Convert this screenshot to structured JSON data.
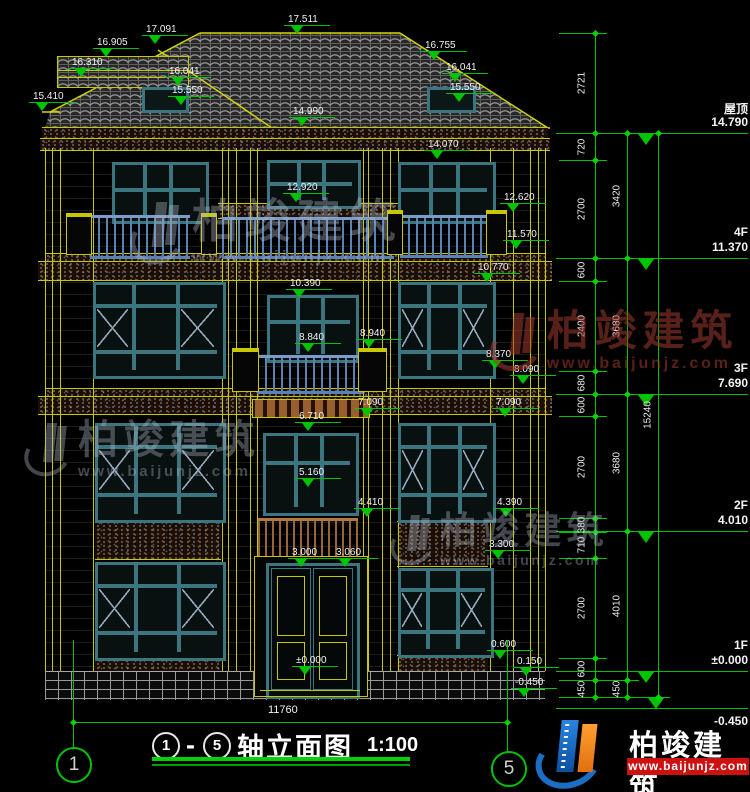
{
  "drawing_title": {
    "axis_start": "1",
    "axis_end": "5",
    "dash": "-",
    "text": "轴立面图",
    "scale": "1:100"
  },
  "bottom_dim": {
    "value": "11760"
  },
  "axis_bubbles": [
    {
      "num": "1"
    },
    {
      "num": "5"
    }
  ],
  "floor_levels": [
    {
      "label": "屋顶",
      "value": "14.790",
      "y": 133,
      "below": false
    },
    {
      "label": "4F",
      "value": "11.370",
      "y": 258,
      "below": false
    },
    {
      "label": "3F",
      "value": "7.690",
      "y": 394,
      "below": false
    },
    {
      "label": "2F",
      "value": "4.010",
      "y": 531,
      "below": false
    },
    {
      "label": "1F",
      "value": "±0.000",
      "y": 671,
      "below": false
    },
    {
      "label": "",
      "value": "-0.450",
      "y": 708,
      "below": true
    }
  ],
  "elevation_marks": [
    {
      "v": "17.511",
      "x": 288,
      "y": 14
    },
    {
      "v": "16.905",
      "x": 97,
      "y": 37
    },
    {
      "v": "17.091",
      "x": 146,
      "y": 24
    },
    {
      "v": "16.310",
      "x": 72,
      "y": 57
    },
    {
      "v": "16.041",
      "x": 169,
      "y": 66
    },
    {
      "v": "15.550",
      "x": 172,
      "y": 85
    },
    {
      "v": "15.410",
      "x": 33,
      "y": 91
    },
    {
      "v": "14.990",
      "x": 293,
      "y": 106
    },
    {
      "v": "16.755",
      "x": 425,
      "y": 40
    },
    {
      "v": "16.041",
      "x": 446,
      "y": 62
    },
    {
      "v": "15.550",
      "x": 450,
      "y": 82
    },
    {
      "v": "14.070",
      "x": 428,
      "y": 139
    },
    {
      "v": "12.920",
      "x": 287,
      "y": 182
    },
    {
      "v": "12.620",
      "x": 504,
      "y": 192
    },
    {
      "v": "11.570",
      "x": 507,
      "y": 229
    },
    {
      "v": "10.770",
      "x": 478,
      "y": 262
    },
    {
      "v": "10.390",
      "x": 290,
      "y": 278
    },
    {
      "v": "8.840",
      "x": 299,
      "y": 332
    },
    {
      "v": "8.940",
      "x": 360,
      "y": 328
    },
    {
      "v": "8.370",
      "x": 486,
      "y": 349
    },
    {
      "v": "8.090",
      "x": 514,
      "y": 364
    },
    {
      "v": "7.090",
      "x": 358,
      "y": 397
    },
    {
      "v": "7.090",
      "x": 496,
      "y": 397
    },
    {
      "v": "6.710",
      "x": 299,
      "y": 411
    },
    {
      "v": "5.160",
      "x": 299,
      "y": 467
    },
    {
      "v": "4.410",
      "x": 358,
      "y": 497
    },
    {
      "v": "4.390",
      "x": 497,
      "y": 497
    },
    {
      "v": "3.300",
      "x": 489,
      "y": 539
    },
    {
      "v": "3.000",
      "x": 292,
      "y": 547
    },
    {
      "v": "3.060",
      "x": 336,
      "y": 547
    },
    {
      "v": "±0.000",
      "x": 296,
      "y": 655
    },
    {
      "v": "0.600",
      "x": 491,
      "y": 639
    },
    {
      "v": "0.150",
      "x": 517,
      "y": 656
    },
    {
      "v": "-0.450",
      "x": 515,
      "y": 677
    }
  ],
  "dim_chains": [
    {
      "x": 595,
      "label_x": 582,
      "boundaries": [
        33,
        133,
        160,
        258,
        281,
        371,
        394,
        416,
        518,
        532,
        558,
        658,
        680,
        697
      ],
      "labels": [
        "2721",
        "720",
        "2700",
        "600",
        "2400",
        "680",
        "600",
        "2700",
        "380",
        "710",
        "2700",
        "600",
        "450"
      ]
    },
    {
      "x": 627,
      "label_x": 617,
      "boundaries": [
        133,
        258,
        394,
        531,
        680,
        697
      ],
      "labels": [
        "3420",
        "3680",
        "3680",
        "4010",
        "450"
      ]
    },
    {
      "x": 658,
      "label_x": 648,
      "boundaries": [
        133,
        697
      ],
      "labels": [
        "15240"
      ]
    }
  ],
  "watermark": {
    "name": "柏竣建筑",
    "url": "www.baijunjz.com"
  },
  "brand": {
    "name": "柏竣建筑",
    "url": "www.baijunjz.com"
  },
  "colors": {
    "line_yellow": "#c8c800",
    "dim_green": "#00c400",
    "frame_teal": "#3a7580",
    "rail_blue": "#5b82b4",
    "rail_brown": "#9a6535",
    "text_white": "#f2f2f2",
    "brand_red": "#cc1111",
    "brand_blue": "#1a6fc4",
    "brand_orange": "#f08a1e",
    "watermark_gray": "rgba(175,185,200,0.38)",
    "watermark_red": "rgba(160,58,46,0.55)"
  }
}
